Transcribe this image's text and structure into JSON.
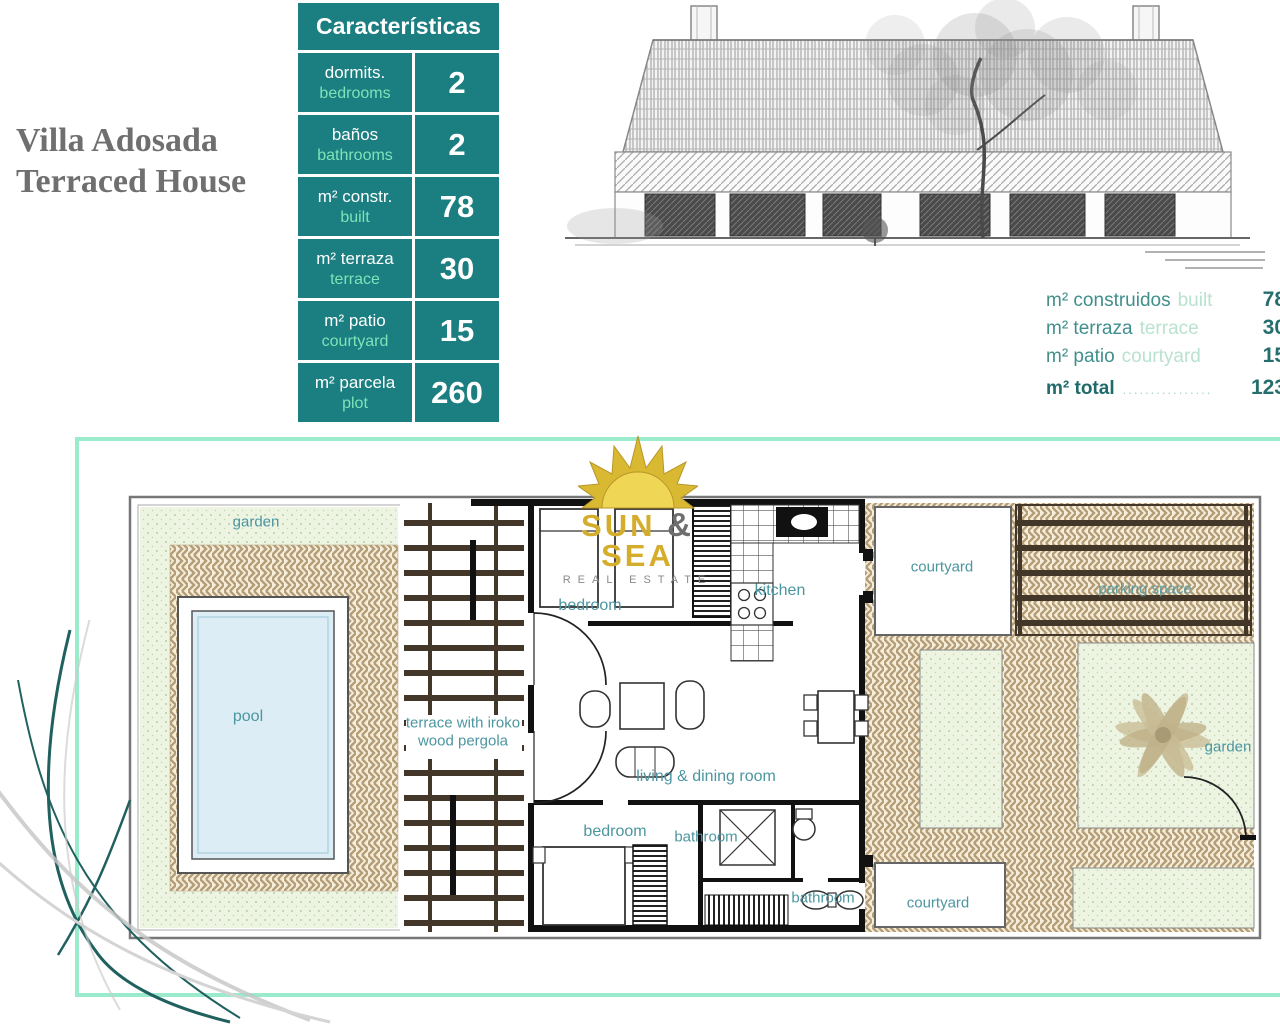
{
  "title": {
    "line1": "Villa Adosada",
    "line2": "Terraced House"
  },
  "characteristics": {
    "header": "Características",
    "rows": [
      {
        "es": "dormits.",
        "en": "bedrooms",
        "value": "2"
      },
      {
        "es": "baños",
        "en": "bathrooms",
        "value": "2"
      },
      {
        "es": "m² constr.",
        "en": "built",
        "value": "78"
      },
      {
        "es": "m² terraza",
        "en": "terrace",
        "value": "30"
      },
      {
        "es": "m² patio",
        "en": "courtyard",
        "value": "15"
      },
      {
        "es": "m² parcela",
        "en": "plot",
        "value": "260"
      }
    ]
  },
  "summary": {
    "rows": [
      {
        "es": "m² construidos",
        "en": "built",
        "value": "78"
      },
      {
        "es": "m² terraza",
        "en": "terrace",
        "value": "30"
      },
      {
        "es": "m² patio",
        "en": "courtyard",
        "value": "15"
      }
    ],
    "total": {
      "label": "m² total",
      "dots": "................",
      "value": "123"
    }
  },
  "logo": {
    "word1": "SUN",
    "amp": "&",
    "word2": "SEA",
    "tagline": "REAL ESTATE"
  },
  "floor_plan": {
    "labels": {
      "garden_left": "garden",
      "pool": "pool",
      "terrace_line1": "terrace with iroko",
      "terrace_line2": "wood pergola",
      "bedroom_top": "bedroom",
      "kitchen": "kitchen",
      "courtyard_top": "courtyard",
      "parking_space": "parking space",
      "garden_right": "garden",
      "living_dining": "living & dining room",
      "bedroom_bottom": "bedroom",
      "bathroom_middle": "bathroom",
      "bathroom_bottom": "bathroom",
      "courtyard_bottom": "courtyard"
    }
  },
  "colors": {
    "teal": "#1b7e80",
    "mint_text": "#7fe3b9",
    "mint_border": "#9aeacc",
    "plan_label_teal": "#4c96a0",
    "title_gray": "#6f6f6f",
    "herringbone_tan": "#b49e78",
    "garden_green": "#edf4e2",
    "pool_blue": "#dcedf5",
    "pergola_brown": "#43372a",
    "logo_gold": "#d4ad2c"
  }
}
